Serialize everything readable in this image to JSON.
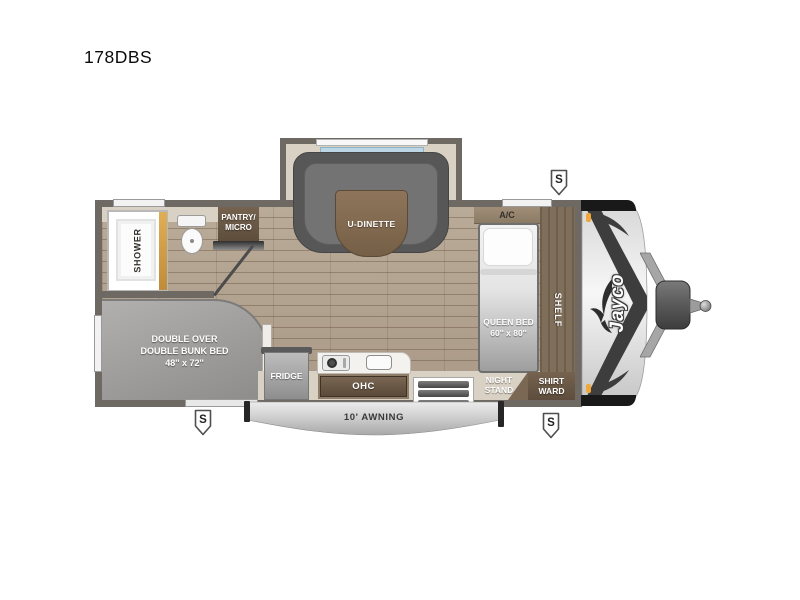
{
  "title": "178DBS",
  "floorplan": {
    "shower": "SHOWER",
    "pantry": [
      "PANTRY/",
      "MICRO"
    ],
    "dinette": "U-DINETTE",
    "ac": "A/C",
    "queen_bed": [
      "QUEEN BED",
      "60'' x 80''"
    ],
    "shelf": "SHELF",
    "bunk": [
      "DOUBLE OVER",
      "DOUBLE BUNK BED",
      "48'' x 72''"
    ],
    "fridge": "FRIDGE",
    "ohc": "OHC",
    "night_stand": [
      "NIGHT",
      "STAND"
    ],
    "shirt_ward": [
      "SHIRT",
      "WARD"
    ],
    "awning": "10' AWNING",
    "brand": "Jayco",
    "stabilizer_jack": "S"
  },
  "colors": {
    "wall": "#6f6963",
    "floor_wood": "#b2a18d",
    "interior_cream": "#d9d1c3",
    "cabinet_brown": "#6e5c4b",
    "furniture_gray": "#9c9c9c",
    "window_glass": "#bcd6e5",
    "marker_light_orange": "#f0a83c",
    "front_cap_silver": "#dcdcdc"
  }
}
